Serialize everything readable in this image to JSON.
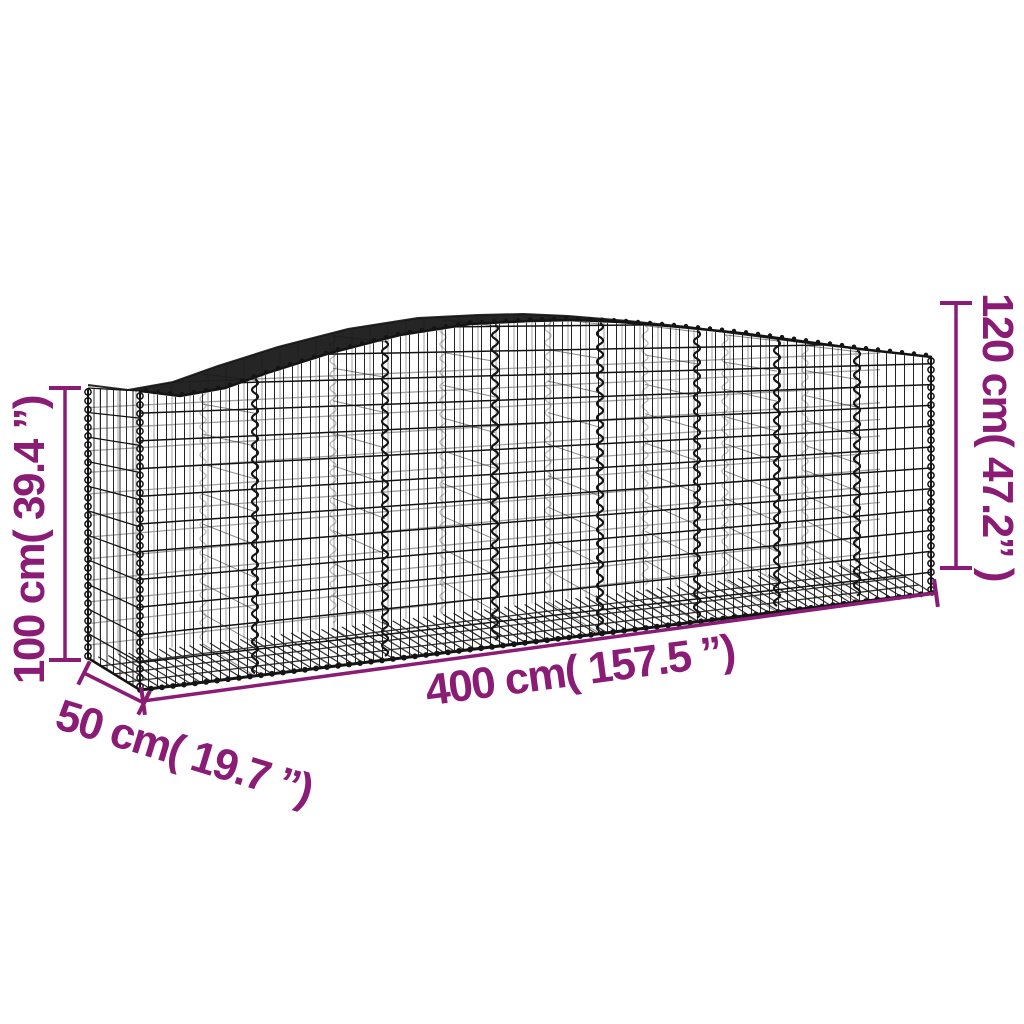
{
  "illustration": {
    "subject": "arched-gabion-basket-wire-mesh",
    "wire_color": "#141414",
    "accent_color": "#8a1c76",
    "background_color": "#ffffff"
  },
  "dimensions": {
    "height_left": "100 cm( 39.4 ”)",
    "height_right": "120 cm( 47.2” )",
    "length": "400 cm( 157.5 ”)",
    "depth": "50 cm( 19.7 ”)"
  }
}
